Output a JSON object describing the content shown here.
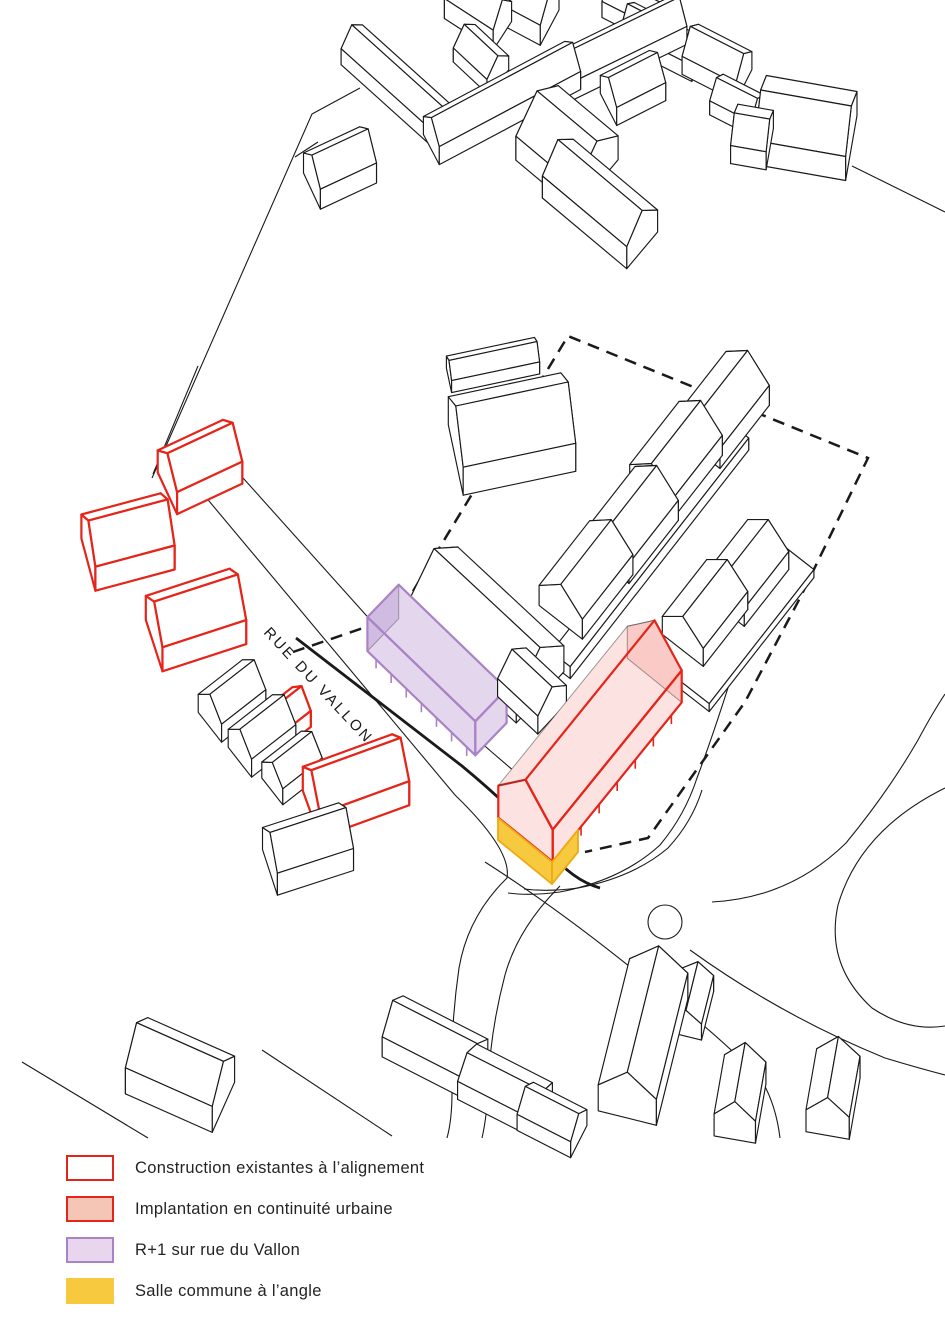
{
  "canvas": {
    "width": 945,
    "height": 1339,
    "background": "#ffffff"
  },
  "colors": {
    "line": "#1a1a1a",
    "red": "#e5251a",
    "red_fill": "rgba(229,37,26,0.13)",
    "purple": "#aa82c6",
    "purple_fill": "rgba(170,130,198,0.32)",
    "yellow": "#f6c93f",
    "yellow_stroke": "#ecaa15",
    "back_line": "rgba(60,60,60,0.5)",
    "white": "#ffffff"
  },
  "street_label": {
    "text": "RUE DU VALLON",
    "x": 263,
    "y": 633,
    "rotation": 47,
    "font_size": 15,
    "letter_spacing": 2.5
  },
  "legend": {
    "items": [
      {
        "label": "Construction existantes à l’alignement",
        "swatch_fill": "#ffffff",
        "swatch_stroke": "#e5251a",
        "swatch_stroke_w": 2.5,
        "top": 1155
      },
      {
        "label": "Implantation en continuité urbaine",
        "swatch_fill": "#f5c6b5",
        "swatch_stroke": "#e5251a",
        "swatch_stroke_w": 2.5,
        "top": 1196
      },
      {
        "label": "R+1 sur rue du Vallon",
        "swatch_fill": "#e8d6ef",
        "swatch_stroke": "#aa82c6",
        "swatch_stroke_w": 2.3,
        "top": 1237
      },
      {
        "label": "Salle commune à l’angle",
        "swatch_fill": "#f6c93f",
        "swatch_stroke": "none",
        "swatch_stroke_w": 0,
        "top": 1278
      }
    ]
  },
  "site_plan": {
    "dashed_boundary": {
      "d": "M293,652 L398,616 L568,336 L868,458 L800,598 L745,702 L648,838 L585,852",
      "width": 2.5,
      "dash": "12 8"
    },
    "roads": [
      {
        "d": "M168,452 L455,795 Q512,850 507,878 Q468,916 459,968 Q450,1030 452,1092 Q452,1120 447,1138",
        "w": 1.1
      },
      {
        "d": "M200,430 L478,740 Q520,777 558,807",
        "w": 1.1
      },
      {
        "d": "M712,902 Q790,898 846,843 Q888,792 918,740 Q933,712 945,694",
        "w": 1.1
      },
      {
        "d": "M560,886 Q518,928 505,975 Q490,1032 488,1088 Q487,1116 482,1138",
        "w": 1.1
      },
      {
        "d": "M485,862 Q560,910 640,975 Q720,1035 762,1081 Q776,1105 780,1138",
        "w": 1.1
      },
      {
        "d": "M690,950 Q780,1015 885,1058 Q918,1068 945,1075",
        "w": 1.1
      },
      {
        "d": "M945,788 Q860,830 838,905 Q825,965 872,1008 Q908,1032 945,1026",
        "w": 1.1
      },
      {
        "d": "M768,552 Q730,690 697,778 Q685,815 660,845 Q622,880 560,892 Q530,896 508,893",
        "w": 1.1
      },
      {
        "d": "M702,790 Q692,822 668,848 Q634,877 578,888 Q548,892 524,889",
        "w": 1.1
      },
      {
        "d": "M22,1062 L148,1138",
        "w": 1.1
      },
      {
        "d": "M262,1050 L392,1136",
        "w": 1.1
      },
      {
        "d": "M360,88 L312,114 L152,478",
        "w": 1.1
      },
      {
        "d": "M198,366 L153,474",
        "w": 1.1
      },
      {
        "d": "M852,166 L945,212",
        "w": 1.1
      },
      {
        "d": "M318,142 L295,157",
        "w": 1.1
      },
      {
        "d": "M296,638 L462,766 Q520,814 549,851 Q572,880 600,888",
        "w": 2.8
      }
    ],
    "circles": [
      {
        "cx": 665,
        "cy": 922,
        "r": 17,
        "w": 1.1
      }
    ],
    "buildings": [
      {
        "c": [
          340,
          178
        ],
        "l": 62,
        "w": 40,
        "r": -25,
        "h": 20,
        "rh": 16
      },
      {
        "c": [
          402,
          98
        ],
        "l": 135,
        "w": 32,
        "r": 42,
        "h": 16,
        "rh": 12
      },
      {
        "c": [
          481,
          66
        ],
        "l": 46,
        "w": 32,
        "r": 43,
        "h": 14,
        "rh": 12
      },
      {
        "c": [
          502,
          112
        ],
        "l": 160,
        "w": 34,
        "r": -28,
        "h": 18,
        "rh": 14
      },
      {
        "c": [
          612,
          62
        ],
        "l": 150,
        "w": 34,
        "r": -26,
        "h": 18,
        "rh": 14
      },
      {
        "c": [
          567,
          160
        ],
        "l": 78,
        "w": 66,
        "r": 40,
        "h": 24,
        "rh": 20
      },
      {
        "c": [
          600,
          215
        ],
        "l": 110,
        "w": 48,
        "r": 40,
        "h": 22,
        "rh": 18
      },
      {
        "c": [
          478,
          20
        ],
        "l": 58,
        "w": 34,
        "r": 33,
        "h": 20,
        "rh": 16
      },
      {
        "c": [
          524,
          14
        ],
        "l": 58,
        "w": 40,
        "r": 28,
        "h": 20,
        "rh": 16
      },
      {
        "c": [
          640,
          20
        ],
        "l": 70,
        "w": 30,
        "r": 27,
        "h": 16,
        "rh": 12
      },
      {
        "c": [
          663,
          50
        ],
        "l": 80,
        "w": 30,
        "r": 27,
        "h": 16,
        "rh": 12
      },
      {
        "c": [
          633,
          97
        ],
        "l": 55,
        "w": 36,
        "r": -27,
        "h": 18,
        "rh": 14
      },
      {
        "c": [
          717,
          72
        ],
        "l": 60,
        "w": 36,
        "r": 27,
        "h": 18,
        "rh": 14
      },
      {
        "c": [
          737,
          112
        ],
        "l": 46,
        "w": 30,
        "r": 27,
        "h": 14,
        "rh": 10
      },
      {
        "c": [
          806,
          140
        ],
        "l": 92,
        "w": 66,
        "r": 10,
        "h": 24,
        "rh": 18
      },
      {
        "c": [
          752,
          146
        ],
        "l": 36,
        "w": 42,
        "r": 10,
        "h": 18,
        "rh": 12
      },
      {
        "c": [
          493,
          371
        ],
        "l": 90,
        "w": 25,
        "r": -12,
        "h": 12,
        "rh": 8
      },
      {
        "c": [
          512,
          448
        ],
        "l": 115,
        "w": 72,
        "r": -12,
        "h": 28,
        "rh": 26
      },
      {
        "c": [
          650,
          557
        ],
        "l": 290,
        "w": 24,
        "r": -52,
        "h": 12,
        "rh": 0,
        "flat": true,
        "z": 416
      },
      {
        "c": [
          723,
          420
        ],
        "l": 80,
        "w": 55,
        "r": -52,
        "h": 20,
        "rh": 18
      },
      {
        "c": [
          676,
          470
        ],
        "l": 80,
        "w": 55,
        "r": -52,
        "h": 20,
        "rh": 18
      },
      {
        "c": [
          632,
          535
        ],
        "l": 80,
        "w": 55,
        "r": -52,
        "h": 20,
        "rh": 18
      },
      {
        "c": [
          586,
          590
        ],
        "l": 82,
        "w": 55,
        "r": -52,
        "h": 20,
        "rh": 18
      },
      {
        "c": [
          730,
          620
        ],
        "l": 170,
        "w": 80,
        "r": -52,
        "h": 8,
        "rh": 0,
        "flat": true,
        "z": 575
      },
      {
        "c": [
          705,
          622
        ],
        "l": 72,
        "w": 52,
        "r": -52,
        "h": 18,
        "rh": 16
      },
      {
        "c": [
          746,
          582
        ],
        "l": 72,
        "w": 52,
        "r": -52,
        "h": 18,
        "rh": 16
      },
      {
        "c": [
          487,
          648
        ],
        "l": 145,
        "w": 70,
        "r": 43,
        "h": 26,
        "rh": 24
      },
      {
        "c": [
          532,
          700
        ],
        "l": 55,
        "w": 42,
        "r": 43,
        "h": 18,
        "rh": 14
      },
      {
        "c": [
          437,
          687
        ],
        "l": 150,
        "w": 45,
        "r": 44,
        "h": 34,
        "rh": 0,
        "flat": true,
        "col": "purple",
        "posts": 7,
        "z": 686
      },
      {
        "c": [
          590,
          760
        ],
        "l": 205,
        "w": 70,
        "r": -51,
        "h": 32,
        "rh": 28,
        "col": "red",
        "posts": 7
      },
      {
        "c": [
          200,
          478
        ],
        "l": 72,
        "w": 46,
        "r": -25,
        "h": 22,
        "rh": 18,
        "col": "red_line"
      },
      {
        "c": [
          125,
          528
        ],
        "l": 70,
        "w": 16,
        "r": -15,
        "h": 10,
        "rh": 8,
        "col": "red_line"
      },
      {
        "c": [
          128,
          554
        ],
        "l": 82,
        "w": 54,
        "r": -15,
        "h": 24,
        "rh": 20,
        "col": "red_line"
      },
      {
        "c": [
          196,
          632
        ],
        "l": 88,
        "w": 54,
        "r": -18,
        "h": 24,
        "rh": 20,
        "col": "red_line"
      },
      {
        "c": [
          285,
          728
        ],
        "l": 42,
        "w": 30,
        "r": -38,
        "h": 16,
        "rh": 13,
        "col": "red_line"
      },
      {
        "c": [
          356,
          798
        ],
        "l": 95,
        "w": 50,
        "r": -20,
        "h": 24,
        "rh": 20,
        "col": "red_line"
      },
      {
        "c": [
          232,
          710
        ],
        "l": 56,
        "w": 38,
        "r": -38,
        "h": 18,
        "rh": 15
      },
      {
        "c": [
          262,
          745
        ],
        "l": 56,
        "w": 38,
        "r": -38,
        "h": 18,
        "rh": 15
      },
      {
        "c": [
          292,
          776
        ],
        "l": 50,
        "w": 34,
        "r": -38,
        "h": 16,
        "rh": 13
      },
      {
        "c": [
          308,
          860
        ],
        "l": 80,
        "w": 48,
        "r": -18,
        "h": 22,
        "rh": 18
      },
      {
        "c": [
          180,
          1088
        ],
        "l": 95,
        "w": 55,
        "r": 24,
        "h": 26,
        "rh": 20
      },
      {
        "c": [
          435,
          1058
        ],
        "l": 95,
        "w": 46,
        "r": 27,
        "h": 20,
        "rh": 16
      },
      {
        "c": [
          505,
          1100
        ],
        "l": 85,
        "w": 42,
        "r": 27,
        "h": 18,
        "rh": 10
      },
      {
        "c": [
          552,
          1128
        ],
        "l": 60,
        "w": 36,
        "r": 27,
        "h": 16,
        "rh": 12
      },
      {
        "c": [
          643,
          1055
        ],
        "l": 130,
        "w": 60,
        "r": -76,
        "h": 26,
        "rh": 20
      },
      {
        "c": [
          692,
          1012
        ],
        "l": 50,
        "w": 32,
        "r": -76,
        "h": 16,
        "rh": 10
      },
      {
        "c": [
          740,
          1110
        ],
        "l": 60,
        "w": 42,
        "r": -80,
        "h": 22,
        "rh": 16
      },
      {
        "c": [
          833,
          1105
        ],
        "l": 62,
        "w": 44,
        "r": -80,
        "h": 22,
        "rh": 16
      }
    ],
    "custom_shapes": [
      {
        "name": "salle-commune-corner-left",
        "points": [
          [
            498,
            818
          ],
          [
            552,
            862
          ],
          [
            552,
            884
          ],
          [
            498,
            840
          ]
        ],
        "fill": "yellow",
        "stroke": "yellow_stroke",
        "w": 1.8
      },
      {
        "name": "salle-commune-corner-right",
        "points": [
          [
            552,
            862
          ],
          [
            578,
            830
          ],
          [
            578,
            852
          ],
          [
            552,
            884
          ]
        ],
        "fill": "yellow",
        "stroke": "yellow_stroke",
        "w": 1.8
      }
    ]
  }
}
